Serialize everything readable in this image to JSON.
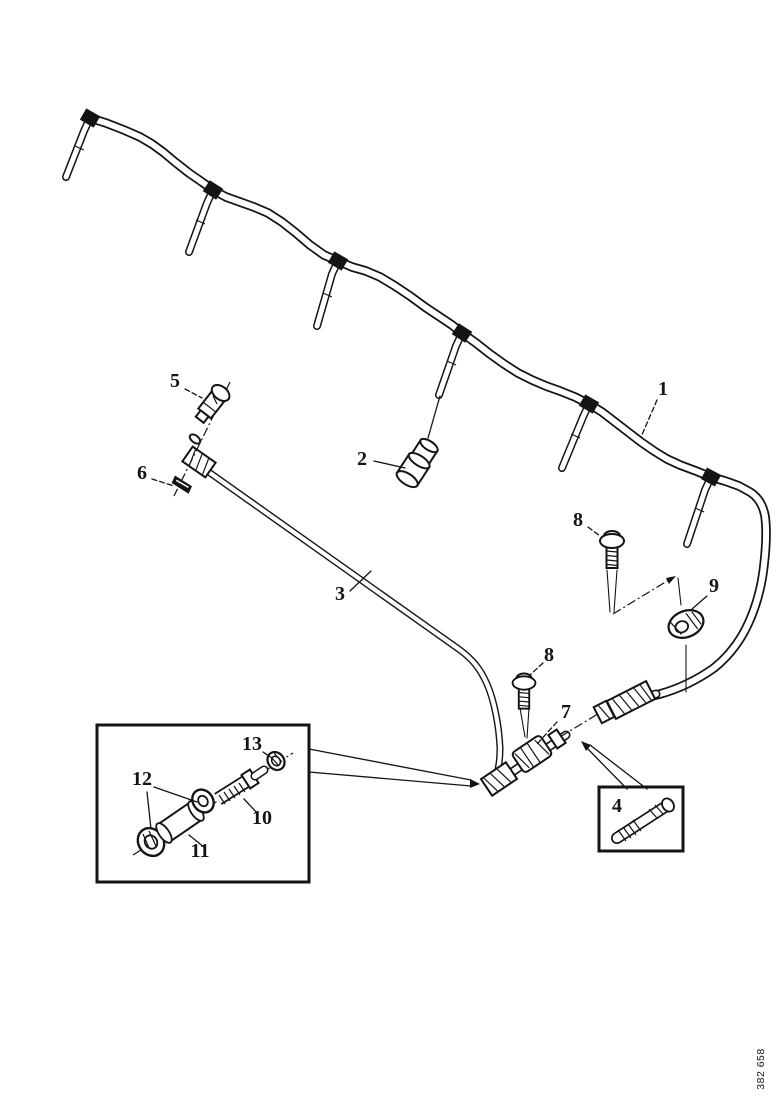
{
  "diagram": {
    "drawing_number": "382 658",
    "colors": {
      "ink": "#141414",
      "background": "#ffffff"
    },
    "callouts": {
      "c1": "1",
      "c2": "2",
      "c3": "3",
      "c4": "4",
      "c5": "5",
      "c6": "6",
      "c7": "7",
      "c8_top": "8",
      "c8_mid": "8",
      "c9": "9",
      "c10": "10",
      "c11": "11",
      "c12": "12",
      "c13": "13"
    }
  }
}
